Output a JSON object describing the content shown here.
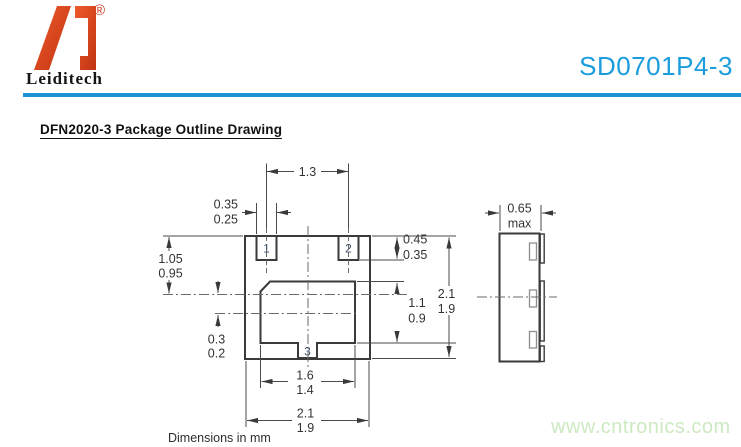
{
  "header": {
    "brand": "Leiditech",
    "registered_mark": "®",
    "part_number": "SD0701P4-3",
    "accent_blue": "#1b9cdd",
    "logo_orange": "#d8431c"
  },
  "title": "DFN2020-3 Package Outline Drawing",
  "drawing": {
    "note": "Dimensions in mm",
    "pads": {
      "p1": "1",
      "p2": "2",
      "p3": "3"
    },
    "dims": {
      "pad_pitch": {
        "value": "1.3"
      },
      "pad_width": {
        "max": "0.35",
        "min": "0.25"
      },
      "top_to_centerline": {
        "max": "1.05",
        "min": "0.95"
      },
      "pad12_depth": {
        "max": "0.45",
        "min": "0.35"
      },
      "pad3_height": {
        "max": "1.1",
        "min": "0.9"
      },
      "body_height": {
        "max": "2.1",
        "min": "1.9"
      },
      "centerline_offset": {
        "max": "0.3",
        "min": "0.2"
      },
      "pad3_width": {
        "max": "1.6",
        "min": "1.4"
      },
      "body_width": {
        "max": "2.1",
        "min": "1.9"
      },
      "thickness": {
        "value": "0.65",
        "qualifier": "max"
      }
    }
  },
  "watermark": {
    "text": "www.cntronics.com",
    "color": "#cde9c2"
  }
}
